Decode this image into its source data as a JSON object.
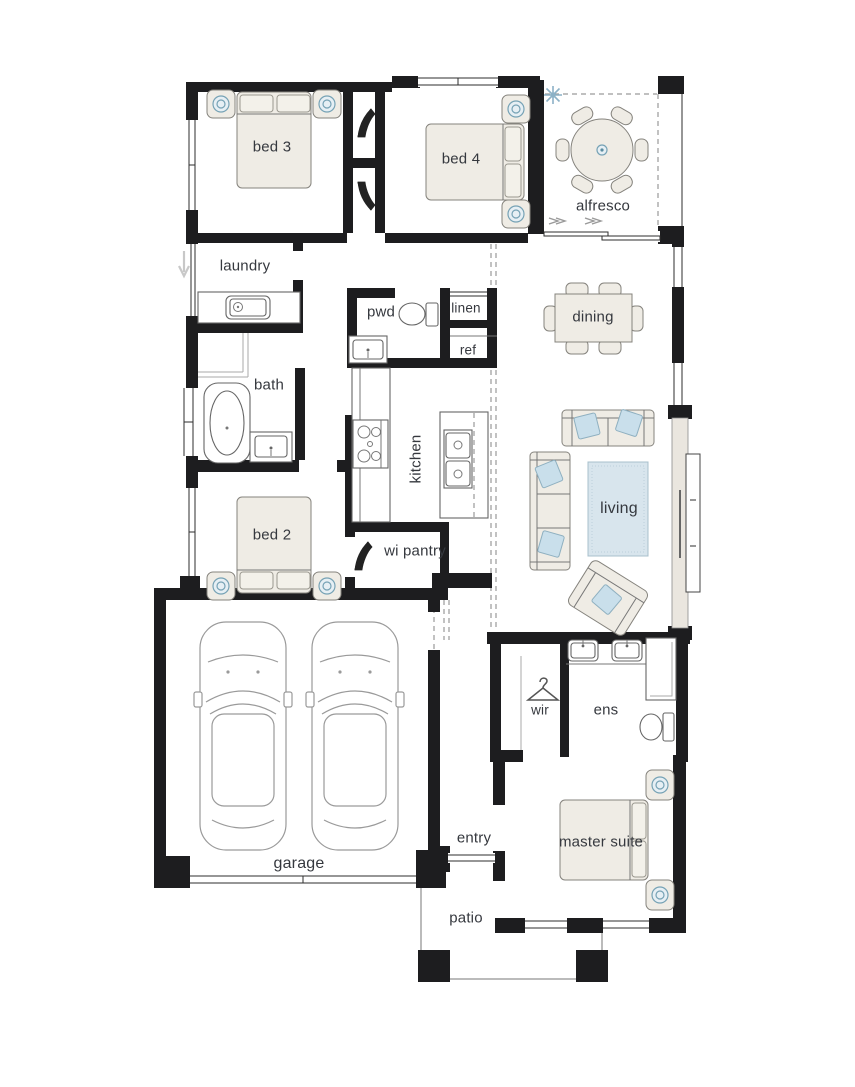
{
  "canvas": {
    "width": 855,
    "height": 1087,
    "background": "#ffffff"
  },
  "palette": {
    "wall": "#1d1d1f",
    "furniture_fill": "#efece5",
    "pillow_fill": "#f3f1ea",
    "accent_blue": "#c9dfeb",
    "rug_fill": "#d8e5ed",
    "lamp_teal": "#76a2b5",
    "label_color": "#35383e",
    "thin_line": "#777777",
    "dash_line": "#9a9a9a"
  },
  "rooms": {
    "bed3": {
      "label": "bed 3"
    },
    "bed4": {
      "label": "bed 4"
    },
    "alfresco": {
      "label": "alfresco"
    },
    "laundry": {
      "label": "laundry"
    },
    "pwd": {
      "label": "pwd"
    },
    "linen": {
      "label": "linen"
    },
    "ref": {
      "label": "ref"
    },
    "dining": {
      "label": "dining"
    },
    "bath": {
      "label": "bath"
    },
    "kitchen": {
      "label": "kitchen"
    },
    "bed2": {
      "label": "bed 2"
    },
    "wi_pantry": {
      "label": "wi pantry"
    },
    "living": {
      "label": "living"
    },
    "wir": {
      "label": "wir"
    },
    "ens": {
      "label": "ens"
    },
    "entry": {
      "label": "entry"
    },
    "garage": {
      "label": "garage"
    },
    "master_suite": {
      "label": "master suite"
    },
    "patio": {
      "label": "patio"
    }
  },
  "icons": [
    "ceiling-fan-icon",
    "door-swing-icon",
    "clothes-hanger-icon",
    "slide-direction-arrow-icon",
    "entry-flow-arrow-icon"
  ]
}
